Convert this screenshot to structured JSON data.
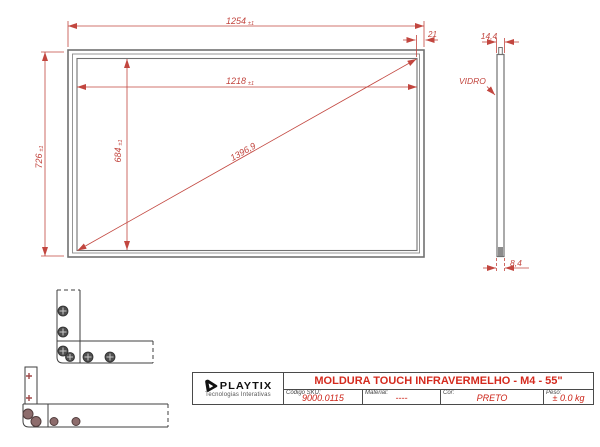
{
  "drawing": {
    "front_view": {
      "outer_width": {
        "value": "1254",
        "tol": "±1"
      },
      "inner_width": {
        "value": "1218",
        "tol": "±1"
      },
      "outer_height": {
        "value": "726",
        "tol": "±1"
      },
      "inner_height": {
        "value": "684",
        "tol": "±1"
      },
      "diagonal": {
        "value": "1396,9"
      },
      "frame_border": {
        "value": "21"
      }
    },
    "side_view": {
      "thickness": {
        "value": "14,4"
      },
      "glass_label": "VIDRO",
      "glass_edge": {
        "value": "8,4"
      }
    }
  },
  "title_block": {
    "logo": {
      "name": "PLAYTIX",
      "subtitle": "Tecnologias Interativas",
      "icon": "playtix-play-triangle-icon"
    },
    "title": "MOLDURA TOUCH INFRAVERMELHO - M4 - 55\"",
    "fields": [
      {
        "label": "Código SKU:",
        "value": "9000.0115"
      },
      {
        "label": "Material:",
        "value": "----"
      },
      {
        "label": "Cor:",
        "value": "PRETO"
      },
      {
        "label": "Peso:",
        "value": "± 0.0 kg"
      }
    ]
  },
  "colors": {
    "dimension_red": "#c2463f",
    "title_red": "#d42a1e",
    "value_red": "#cc2418",
    "frame_gray": "#717171",
    "detail_line": "#3f3f3f",
    "screw_gray": "#4f4f4f",
    "screw_brown": "#8d6c6c",
    "background": "#ffffff"
  }
}
